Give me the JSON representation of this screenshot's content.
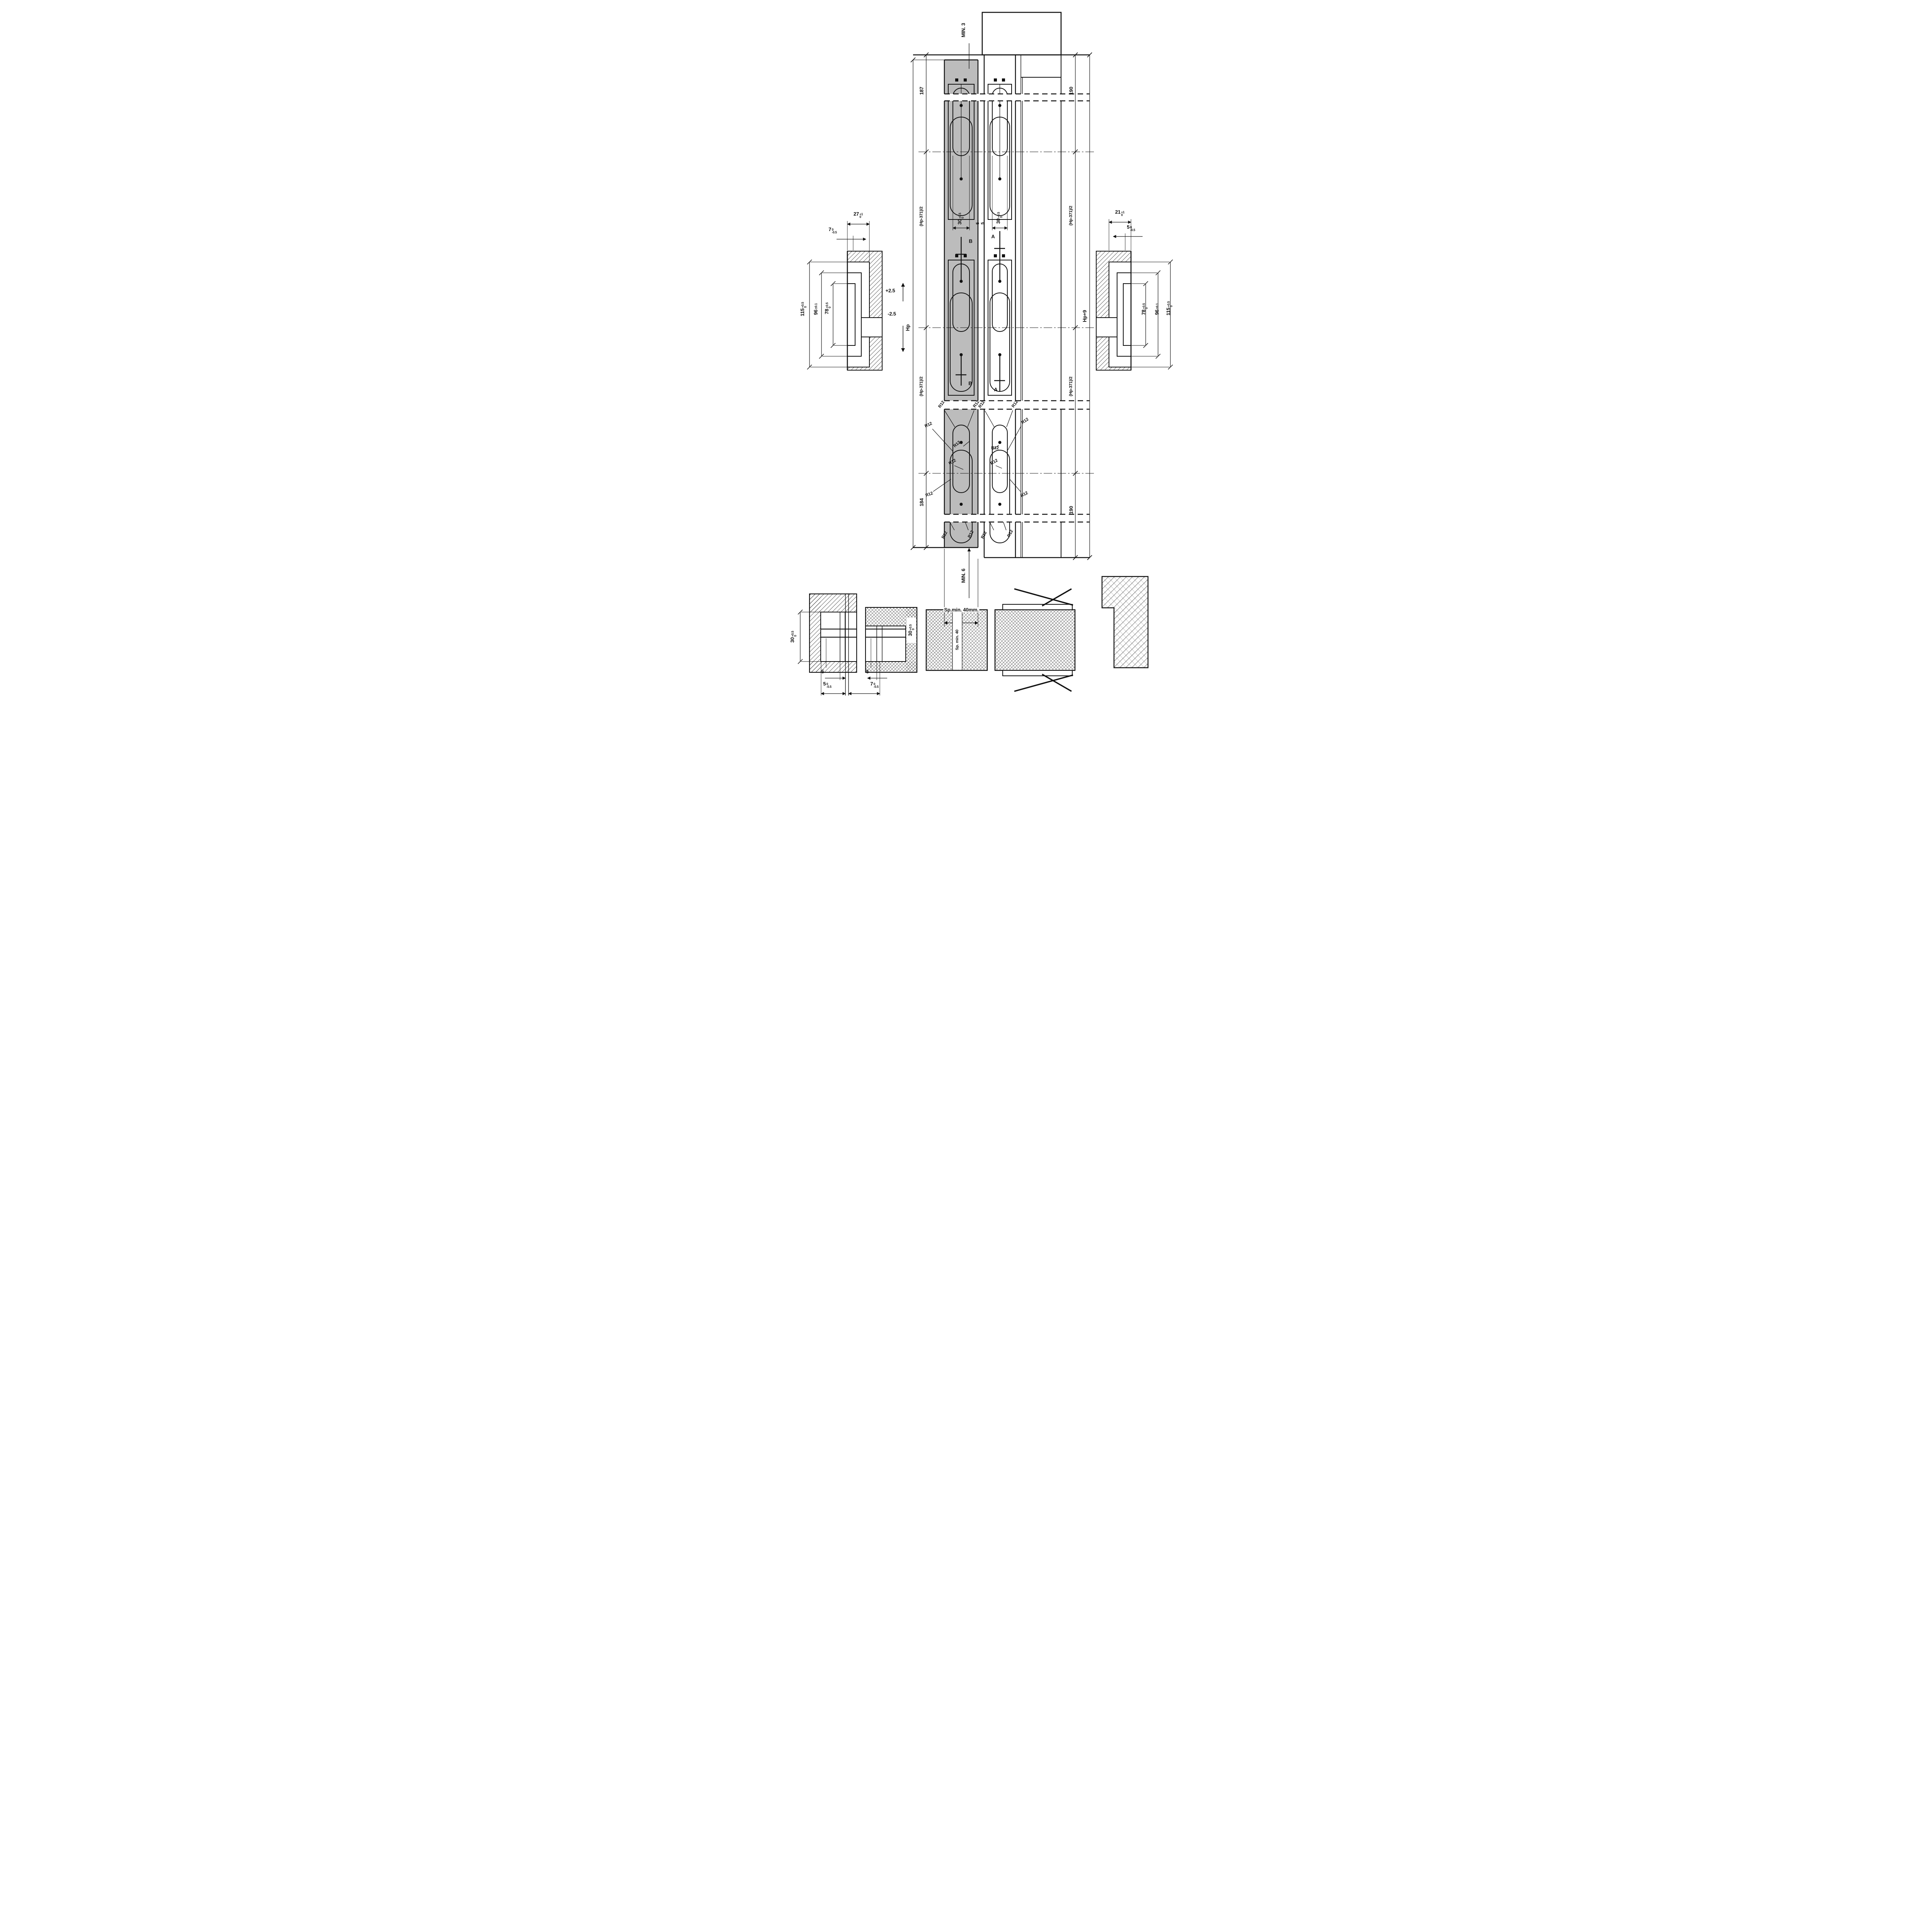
{
  "drawing": {
    "type": "technical-drawing",
    "subject": "concealed-hinge mortise installation drawing (door leaf and frame)"
  },
  "labels": {
    "min_top": "MIN. 3",
    "min_bottom": "MIN. 6",
    "sp_min_40mm": "Sp.min. 40mm.",
    "sp_min_40": "Sp. min. 40",
    "d187": "187",
    "d184": "184",
    "d190": "190",
    "hp_half": "(Hp-371)/2",
    "hp": "Hp",
    "hp9": "Hp+9",
    "plus25": "+2.5",
    "minus25": "-2.5",
    "r12": "R12",
    "d5": "5",
    "sec_a": "A",
    "sec_b": "B"
  },
  "dims": {
    "d30": {
      "v": "30",
      "sup": "+0.5",
      "sub": "0"
    },
    "d27": {
      "v": "27",
      "sup": "+1",
      "sub": "0"
    },
    "d21": {
      "v": "21",
      "sup": "+1",
      "sub": "0"
    },
    "d7": {
      "v": "7",
      "sup": "0",
      "sub": "-0.5"
    },
    "d5t": {
      "v": "5",
      "sup": "0",
      "sub": "-0.5"
    },
    "d115": {
      "v": "115",
      "sup": "+0.5",
      "sub": "0"
    },
    "d96": {
      "v": "96",
      "sup": "±0.1",
      "sub": ""
    },
    "d78": {
      "v": "78",
      "sup": "+0.5",
      "sub": "0"
    },
    "d3": {
      "v": "3",
      "sup": "+3",
      "sub": "-1.5"
    }
  },
  "colors": {
    "line": "#111111",
    "strip_gray": "#bcbcbc",
    "background": "#ffffff"
  }
}
